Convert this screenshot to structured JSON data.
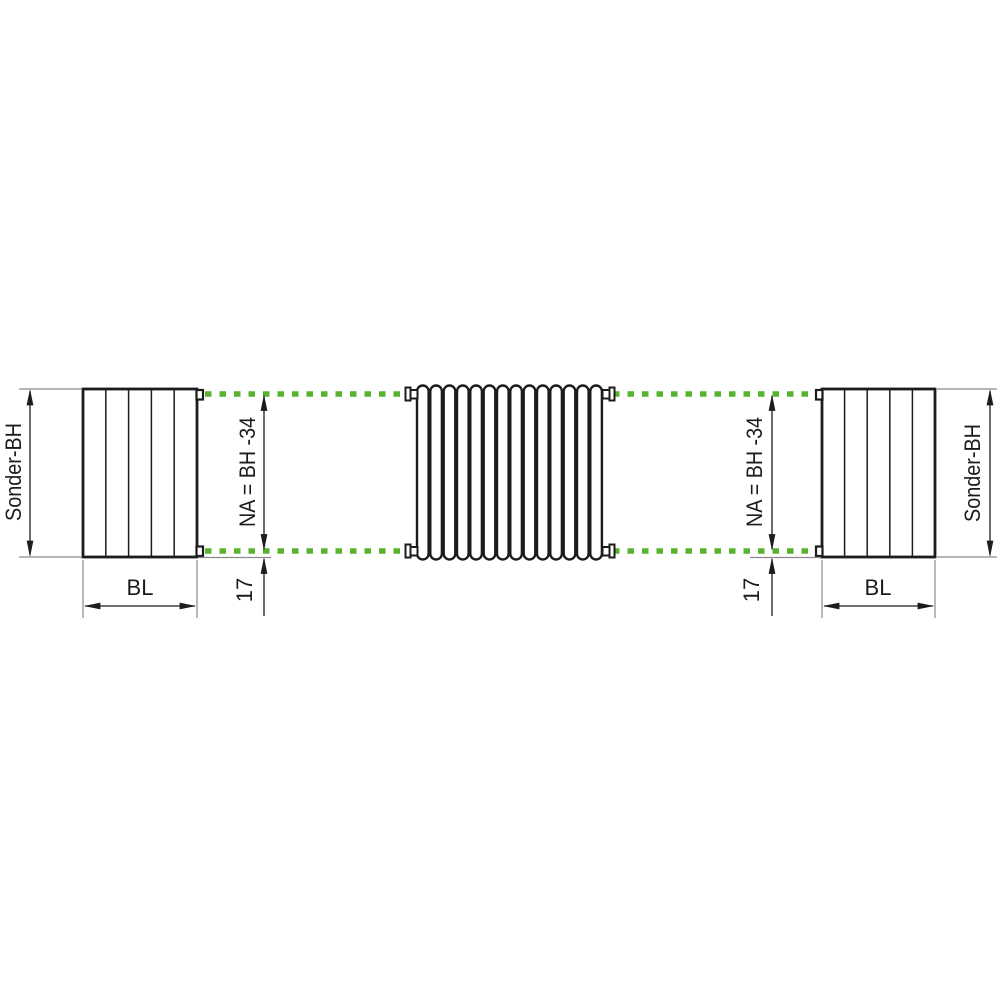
{
  "diagram": {
    "type": "technical-dimension-drawing",
    "subject": "tubular radiator connection dimensions (side views and front view)",
    "labels": {
      "sonder_bh": "Sonder-BH",
      "bl": "BL",
      "na_formula": "NA = BH -34",
      "bottom_offset": "17"
    },
    "colors": {
      "connection_axis_green": "#57B32F",
      "outline_black": "#1c1c1c",
      "extension_gray": "#8a8a8a"
    },
    "front_view": {
      "tube_count": 14
    },
    "side_view": {
      "panel_count": 5
    }
  }
}
